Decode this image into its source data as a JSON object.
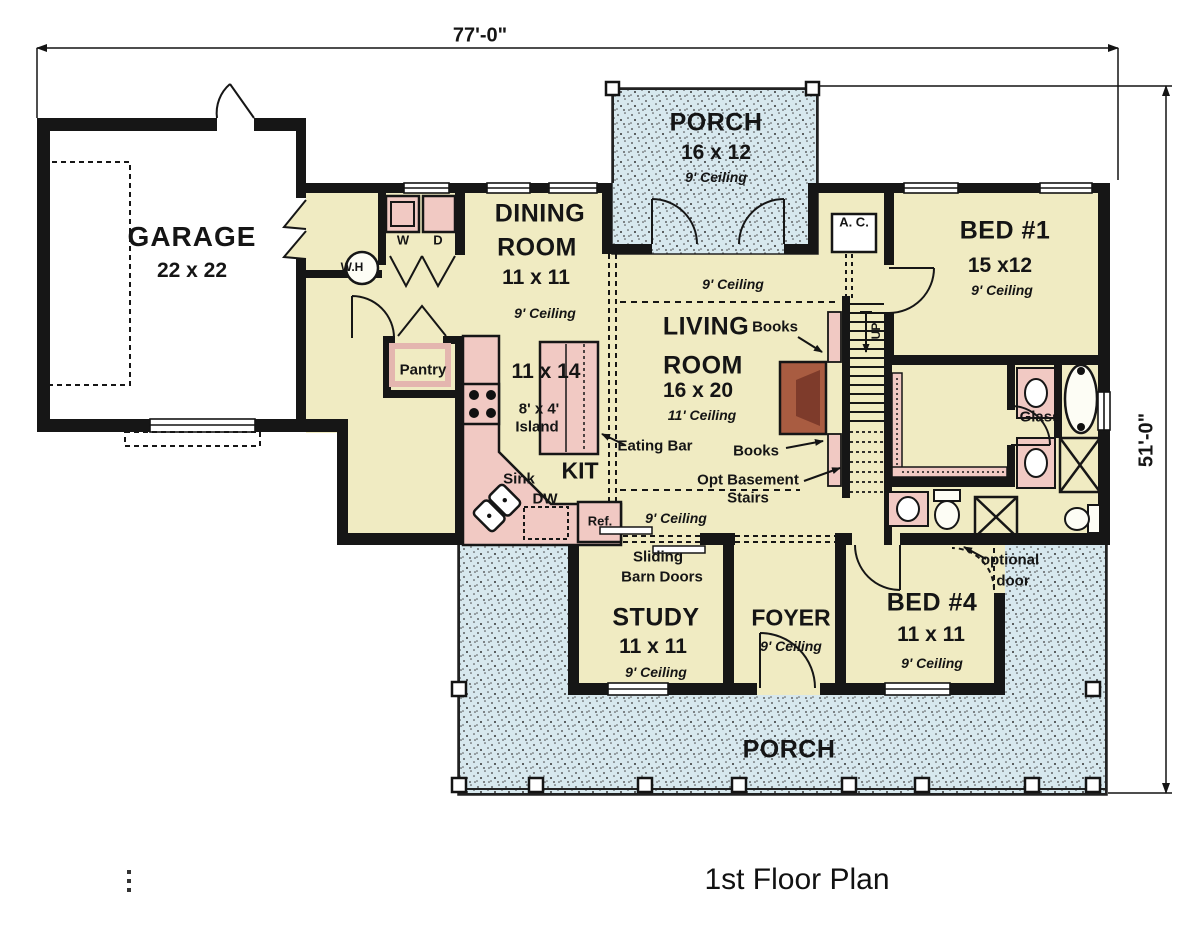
{
  "plan": {
    "title": "1st Floor Plan",
    "width_dim": "77'-0\"",
    "height_dim": "51'-0\""
  },
  "rooms": {
    "garage": {
      "name": "GARAGE",
      "size": "22 x 22"
    },
    "front_porch": {
      "name": "PORCH",
      "size": "16 x 12",
      "ceiling": "9' Ceiling"
    },
    "dining": {
      "name1": "DINING",
      "name2": "ROOM",
      "size": "11 x 11",
      "ceiling": "9' Ceiling"
    },
    "living": {
      "name1": "LIVING",
      "name2": "ROOM",
      "size": "16 x 20",
      "ceiling": "11' Ceiling"
    },
    "kitchen": {
      "name": "KIT",
      "size": "11 x 14",
      "island_size": "8' x 4'",
      "island": "Island"
    },
    "bed1": {
      "name": "BED #1",
      "size": "15 x12",
      "ceiling": "9' Ceiling"
    },
    "study": {
      "name": "STUDY",
      "size": "11 x 11",
      "ceiling": "9' Ceiling"
    },
    "foyer": {
      "name": "FOYER",
      "ceiling": "9' Ceiling"
    },
    "bed4": {
      "name": "BED #4",
      "size": "11 x 11",
      "ceiling": "9' Ceiling"
    },
    "back_porch": {
      "name": "PORCH"
    },
    "hall_upper": {
      "ceiling": "9' Ceiling"
    },
    "hall_lower": {
      "ceiling": "9' Ceiling"
    }
  },
  "labels": {
    "washer": "W",
    "dryer": "D",
    "water_heater": "W.H",
    "pantry": "Pantry",
    "sink": "Sink",
    "dishwasher": "DW",
    "refrigerator": "Ref.",
    "ac": "A. C.",
    "books_upper": "Books",
    "books_lower": "Books",
    "eating_bar": "Eating Bar",
    "opt_basement1": "Opt Basement",
    "opt_basement2": "Stairs",
    "sliding1": "Sliding",
    "sliding2": "Barn Doors",
    "optional1": "optional",
    "optional2": "door",
    "glass": "Glass",
    "up": "UP"
  },
  "colors": {
    "floor": "#f0ebc2",
    "fixture_pink": "#f1c9c3",
    "porch_blue": "#d7e8ee",
    "fireplace": "#a95c41",
    "wall": "#161616"
  }
}
